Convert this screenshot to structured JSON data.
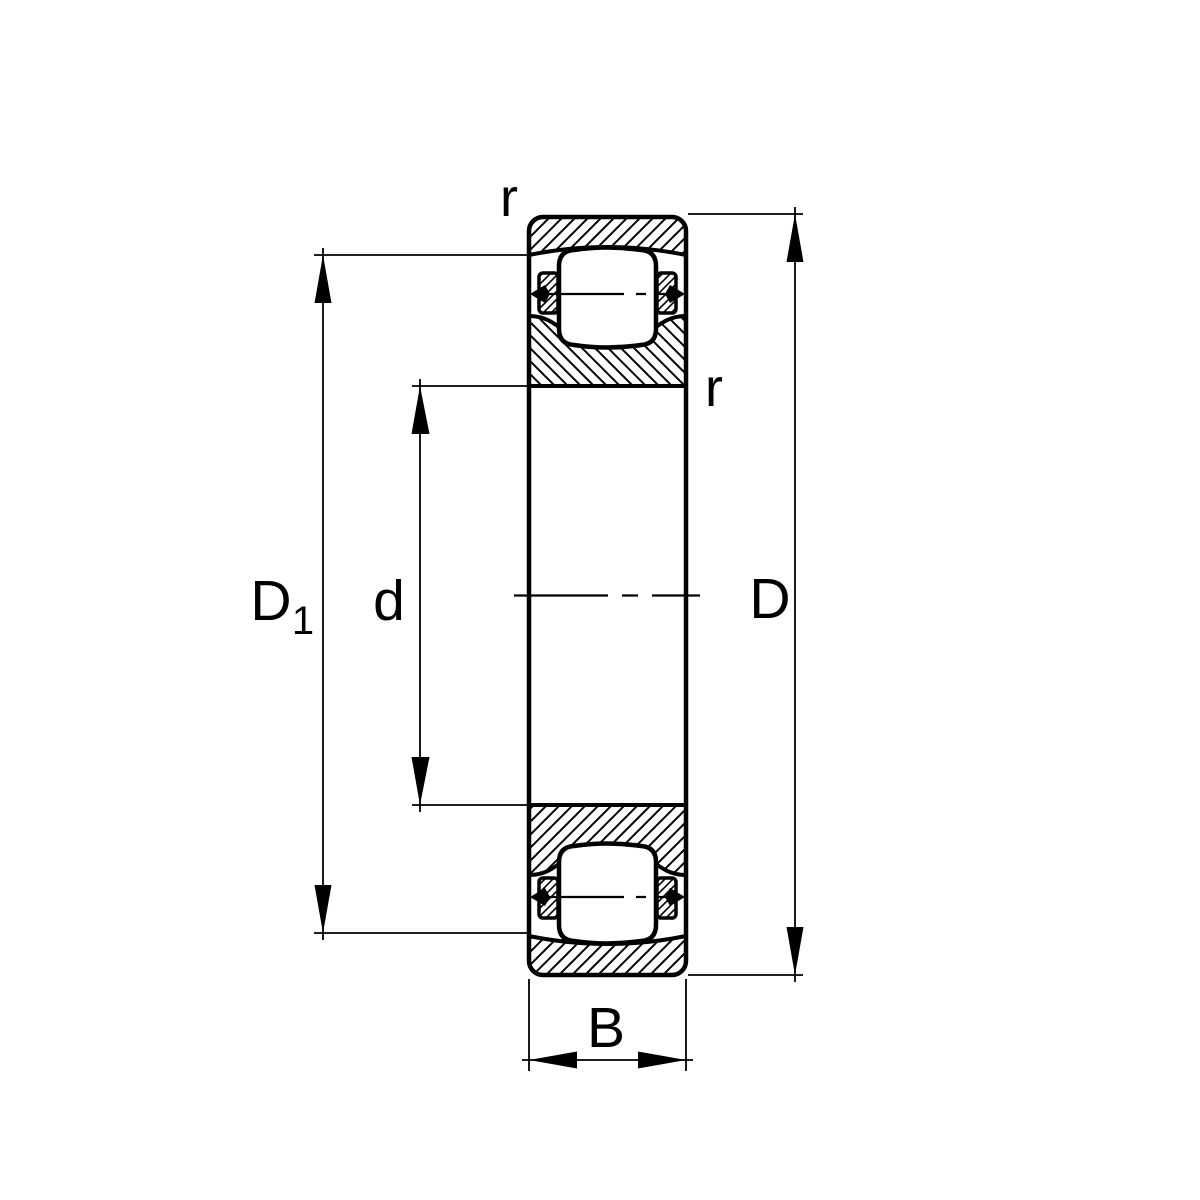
{
  "figure": {
    "kind": "engineering-section-drawing",
    "subject": "Barrel roller bearing axial cross-section with dimension callouts",
    "background": "#ffffff",
    "stroke_color": "#000000"
  },
  "dimension_labels": {
    "shoulder_diameter": {
      "base": "D",
      "subscript": "1"
    },
    "bore_diameter": "d",
    "outside_diameter": "D",
    "width": "B",
    "chamfer_outer": "r",
    "chamfer_inner": "r"
  }
}
